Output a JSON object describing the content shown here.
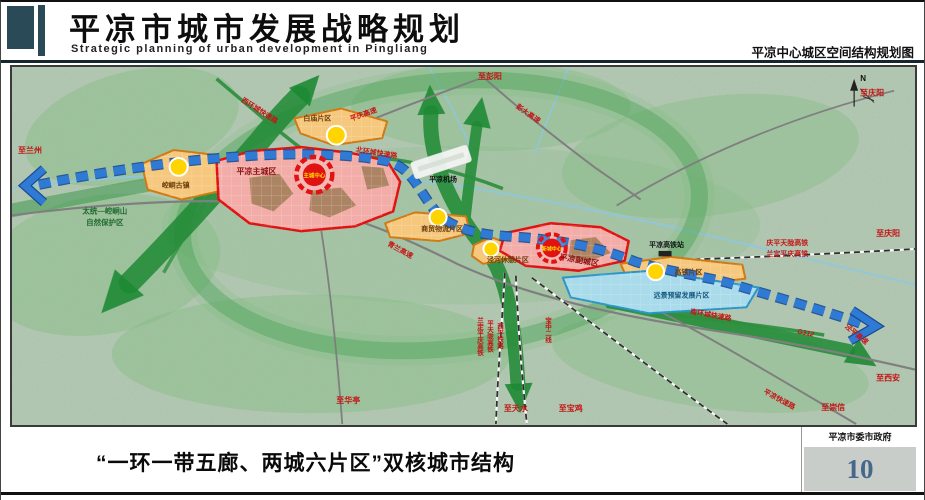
{
  "header": {
    "title": "平凉市城市发展战略规划",
    "subtitle": "Strategic planning of urban development in Pingliang",
    "caption": "平凉中心城区空间结构规划图"
  },
  "map": {
    "zones": {
      "main_city": "平凉主城区",
      "sub_city": "平凉副城区",
      "baimiao": "白庙片区",
      "kongtong": "崆峒古镇",
      "logistics": "商贸物流片区",
      "leisure": "泾河休憩片区",
      "hsr_district": "高铁片区",
      "reserve": "远景预留发展片区"
    },
    "centers": {
      "main": "主城中心",
      "new": "新城中心"
    },
    "landmarks": {
      "airport": "平凉机场",
      "hsr_station": "平凉高铁站",
      "nature_reserve_1": "太统—崆峒山",
      "nature_reserve_2": "自然保护区",
      "compass": "N"
    },
    "roads": {
      "pengda": "彭大高速",
      "pingqing": "平庆高速",
      "qinglan": "青兰高速",
      "west_ring": "西环城快速路",
      "north_ring": "北环城快速路",
      "south_ring": "南环城快速路",
      "g312": "G312",
      "pingliang_expwy": "平凉快速路",
      "jingping": "泾平高速"
    },
    "railways": {
      "qptl": "庆平天陇高铁",
      "ldpq": "兰定平庆高铁",
      "ldpq_v": "兰定平庆高铁",
      "ptl_v": "平天陇高铁",
      "xiping_v": "西平铁路",
      "baozhong_v": "宝中二线"
    },
    "destinations": {
      "lanzhou": "至兰州",
      "pengyang": "至彭阳",
      "qingyang_top": "至庆阳",
      "qingyang_east": "至庆阳",
      "xian": "至西安",
      "chongxin": "至崇信",
      "tianshui": "至天水",
      "baoji": "至宝鸡",
      "huating": "至华亭"
    }
  },
  "footer": {
    "slogan": "“一环一带五廊、两城六片区”双核城市结构",
    "authority": "平凉市委市政府",
    "page_number": "10"
  },
  "colors": {
    "header_accent": "#2b4a58",
    "corridor_green": "#1e8a34",
    "belt_blue": "#2f7ad4",
    "city_red": "#e01212",
    "district_orange": "#cf7a12",
    "center_yellow": "#ffd400",
    "reserve_blue": "#2a96c8",
    "page_number_blue": "#46678c"
  }
}
